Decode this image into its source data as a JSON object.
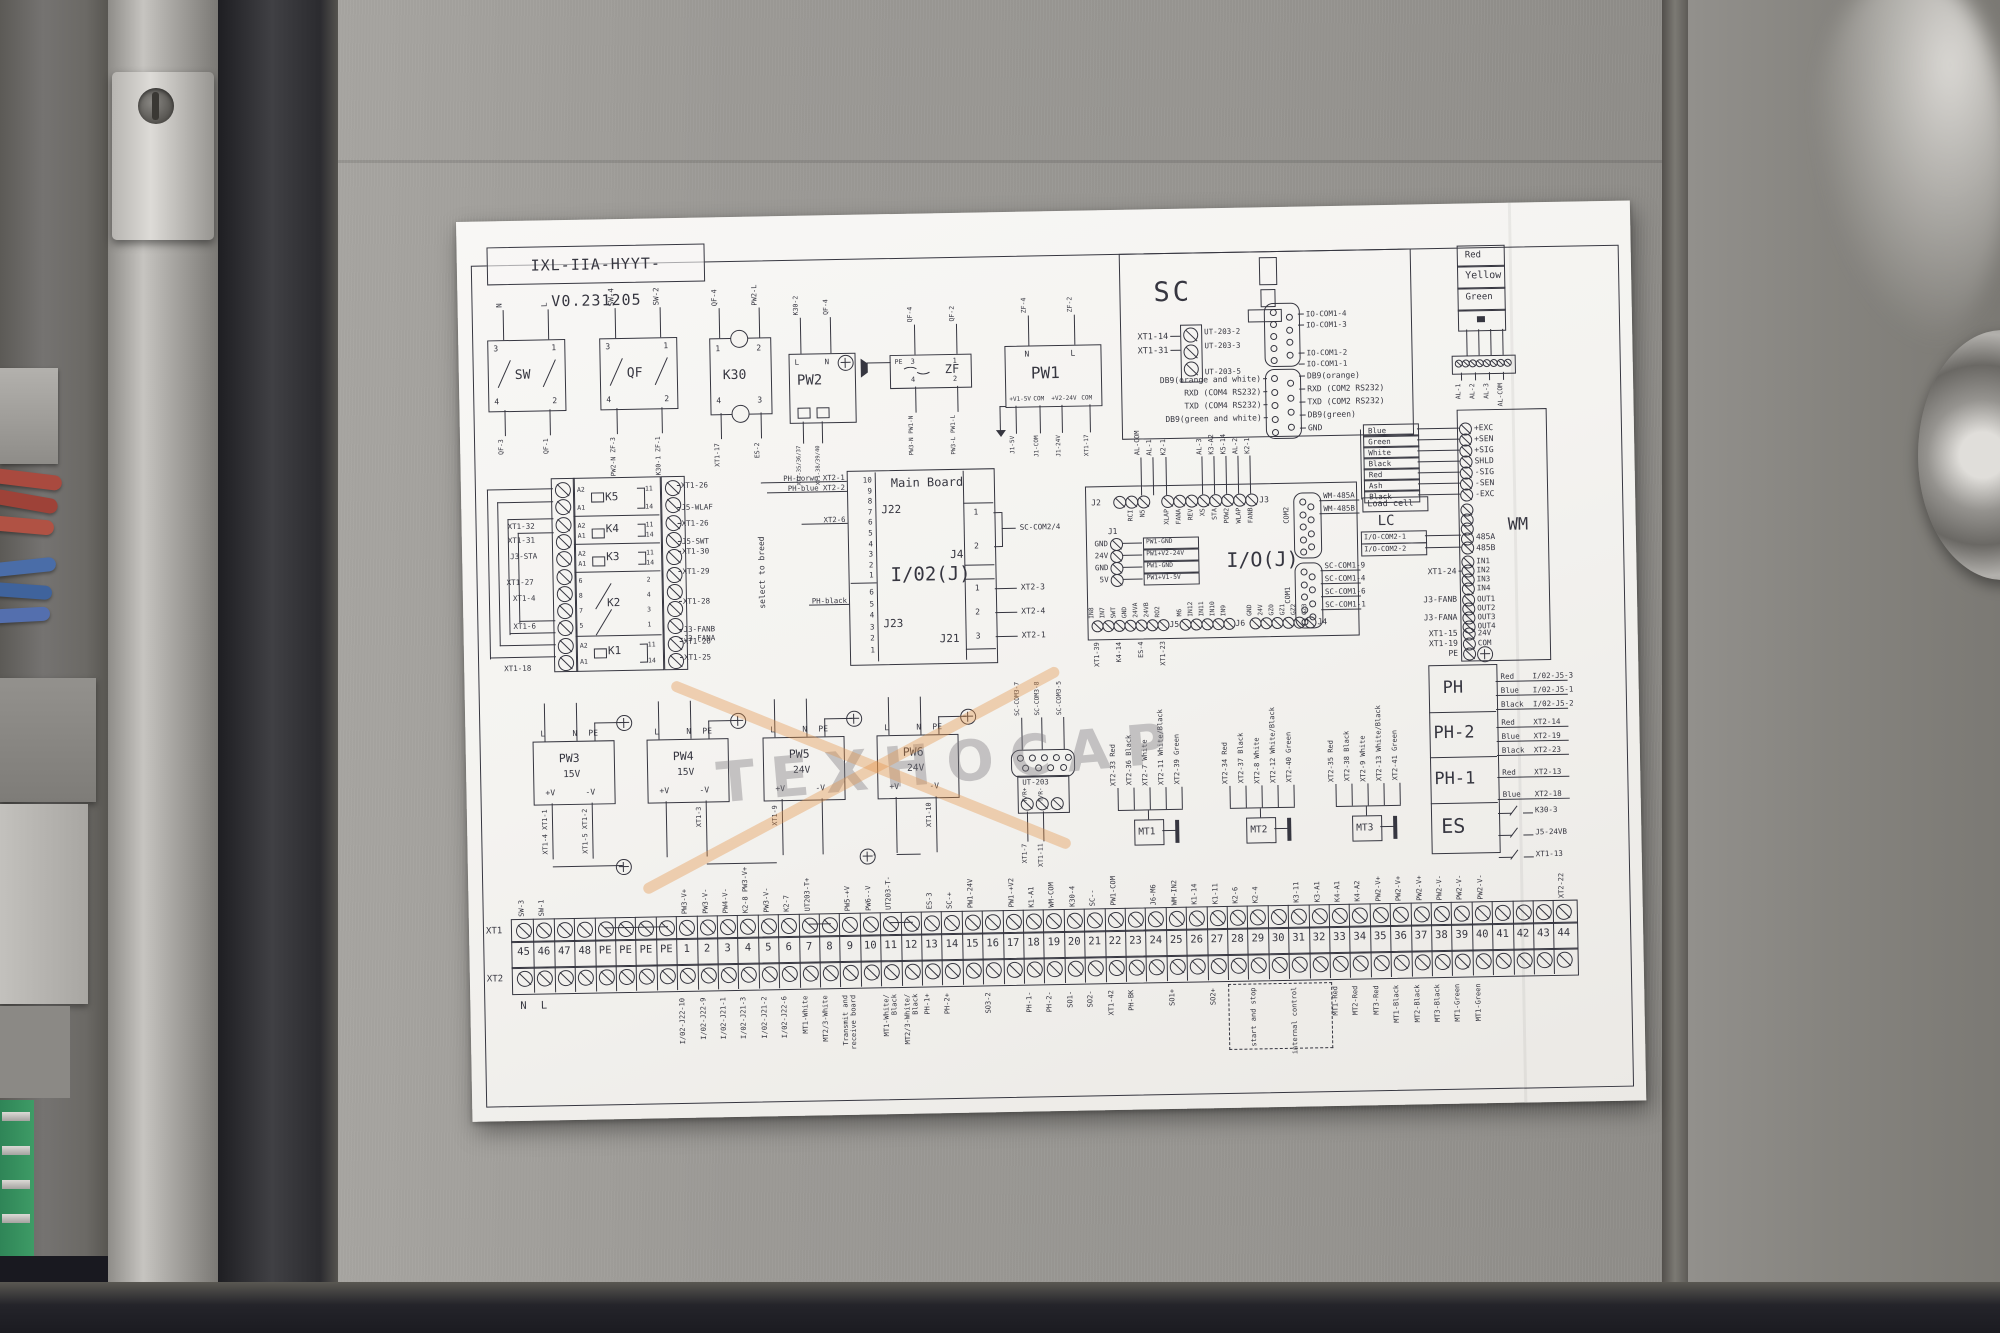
{
  "sheet": {
    "title": "IXL-IIA-HYYT-V0.231205",
    "watermark": "TEXHOCAP"
  },
  "colors": {
    "ink": "#363640",
    "paper": "#f4f3f0",
    "steel": "#9a9894",
    "steel_dark": "#2b2b2f",
    "watermark_gray": "#7c7a80",
    "watermark_orange": "#e49448",
    "pcb_green": "#3e9b66",
    "cable_red": "#a94a3f",
    "cable_blue": "#4a6da8"
  },
  "top_row": {
    "sw": {
      "name": "SW",
      "top_pins": [
        "3",
        "1"
      ],
      "bot_pins": [
        "4",
        "2"
      ],
      "top_wires": [
        "N",
        "L"
      ],
      "bot_wires": [
        "QF-3",
        "QF-1"
      ]
    },
    "qf": {
      "name": "QF",
      "top_pins": [
        "3",
        "1"
      ],
      "bot_pins": [
        "4",
        "2"
      ],
      "top_wires": [
        "SW-4",
        "SW-2"
      ],
      "bot_wires": [
        "PW2-N ZF-3",
        "K30-1 ZF-1"
      ]
    },
    "k30": {
      "name": "K30",
      "top_pins": [
        "1",
        "2"
      ],
      "bot_pins": [
        "4",
        "3"
      ],
      "top_wires": [
        "QF-4",
        "PW2-L"
      ],
      "bot_wires": [
        "XT1-17",
        "ES-2"
      ]
    },
    "pw2": {
      "name": "PW2",
      "top_pins": [
        "L",
        "N"
      ],
      "top_wires": [
        "K30-2",
        "QF-4"
      ],
      "bot_wires": [
        "XT1-35/36/37",
        "XT1-38/39/40"
      ]
    },
    "zf": {
      "name": "ZF",
      "top_pins": [
        "PE",
        "3",
        "1"
      ],
      "top_wires": [
        "QF-4",
        "QF-2"
      ],
      "bot_pins": [
        "4",
        "2"
      ],
      "bot_wires": [
        "PW3-N PW1-N",
        "PW3-L PW1-L"
      ]
    },
    "pw1": {
      "name": "PW1",
      "top_pins": [
        "N",
        "L"
      ],
      "top_wires": [
        "ZF-4",
        "ZF-2"
      ],
      "bot_terms": [
        "+V1-5V",
        "COM",
        "+V2-24V",
        "COM"
      ],
      "bot_wires": [
        "J1-5V",
        "J1-COM",
        "J1-24V",
        "XT1-17"
      ]
    }
  },
  "sc": {
    "name": "SC",
    "left_terms": [
      "XT1-14",
      "XT1-31"
    ],
    "ut_wires": [
      "UT-203-2",
      "UT-203-3",
      "UT-203-5"
    ],
    "io_com": [
      "IO-COM1-4",
      "IO-COM1-3",
      "IO-COM1-2",
      "IO-COM1-1"
    ],
    "db9_left": [
      "DB9(orange and white)",
      "RXD (COM4 RS232)",
      "TXD (COM4 RS232)",
      "DB9(green and white)"
    ],
    "db9_right": [
      "DB9(orange)",
      "RXD (COM2 RS232)",
      "TXD (COM2 RS232)",
      "DB9(green)",
      "GND"
    ]
  },
  "tower": {
    "lamps": [
      "Red",
      "Yellow",
      "Green"
    ],
    "wires": [
      "AL-1",
      "AL-2",
      "AL-3",
      "AL-COM"
    ]
  },
  "wm": {
    "name": "WM",
    "lc_box": "Load cell",
    "lc": "LC",
    "loadcell": [
      [
        "Blue",
        "+EXC"
      ],
      [
        "Green",
        "+SEN"
      ],
      [
        "White",
        "+SIG"
      ],
      [
        "Black",
        "SHLD"
      ],
      [
        "Red",
        "-SIG"
      ],
      [
        "Ash",
        "-SEN"
      ],
      [
        "Black",
        "-EXC"
      ]
    ],
    "rs485": [
      [
        "I/O-COM2-1",
        "485A"
      ],
      [
        "I/O-COM2-2",
        "485B"
      ]
    ],
    "in_label": "XT1-24",
    "ins": [
      "IN1",
      "IN2",
      "IN3",
      "IN4"
    ],
    "out_labels": [
      "J3-FANB",
      "J3-FANA"
    ],
    "outs": [
      "OUT1",
      "OUT2",
      "OUT3",
      "OUT4"
    ],
    "pwr": [
      [
        "XT1-15",
        "24V"
      ],
      [
        "XT1-19",
        "COM"
      ],
      [
        "PE",
        ""
      ]
    ]
  },
  "relays": {
    "note": "select to breed",
    "rows": [
      {
        "name": "K5",
        "lp": [
          "A2",
          "A1"
        ],
        "rp": [
          "11",
          "14"
        ],
        "ll": [],
        "rl": [
          "XT1-26",
          "J5-WLAF"
        ]
      },
      {
        "name": "K4",
        "lp": [
          "A2",
          "A1"
        ],
        "rp": [
          "11",
          "14"
        ],
        "ll": [
          "XT1-32",
          "XT1-31"
        ],
        "rl": [
          "XT1-26",
          "J5-SWT"
        ]
      },
      {
        "name": "K3",
        "lp": [
          "A2",
          "A1"
        ],
        "rp": [
          "11",
          "14"
        ],
        "ll": [
          "J3-STA"
        ],
        "rl": [
          "XT1-30",
          "XT1-29"
        ]
      },
      {
        "name": "K2",
        "lp": [
          "6",
          "8",
          "7",
          "5"
        ],
        "rp": [
          "2",
          "4",
          "3",
          "1"
        ],
        "ll": [
          "XT1-27",
          "XT1-4",
          "XT1-6"
        ],
        "rl": [
          "XT1-28",
          "J3-FANB",
          "J3-FANA"
        ]
      },
      {
        "name": "K1",
        "lp": [
          "A2",
          "A1"
        ],
        "rp": [
          "11",
          "14"
        ],
        "ll": [
          "XT1-18"
        ],
        "rl": [
          "XT1-26",
          "XT1-25"
        ]
      }
    ]
  },
  "main_board": {
    "title": "Main Board",
    "chip": "I/02(J)",
    "j22": {
      "name": "J22",
      "pins": [
        "10",
        "9",
        "8",
        "7",
        "6",
        "5",
        "4",
        "3",
        "2",
        "1"
      ],
      "w10": "PH-borwn XT2-1",
      "w9": "PH-blue XT2-2",
      "w6": "XT2-6"
    },
    "j23": {
      "name": "J23",
      "pins": [
        "6",
        "5",
        "4",
        "3",
        "2",
        "1"
      ],
      "w5": "PH-black"
    },
    "j4": {
      "name": "J4",
      "pins": [
        "1",
        "2"
      ],
      "wire": "SC-COM2/4"
    },
    "j21": {
      "name": "J21",
      "pins": [
        "1",
        "2",
        "3"
      ],
      "wires": [
        "XT2-3",
        "XT2-4",
        "XT2-1"
      ]
    }
  },
  "io": {
    "name": "I/O(J)",
    "j2": {
      "name": "J2",
      "pins": [
        "RCI",
        "N5"
      ],
      "top": [
        "AL-COM",
        "AL-1"
      ]
    },
    "j3": {
      "name": "J3",
      "pins": [
        "XLAP",
        "FANA",
        "REV",
        "XS",
        "STA",
        "POW2",
        "WLAP",
        "FANB"
      ],
      "top": [
        "K2-1",
        "AL-3",
        "K3-A2",
        "K5-14",
        "AL-2",
        "K2-1"
      ]
    },
    "j1": {
      "name": "J1",
      "rows": [
        [
          "GND",
          "PW1-GND"
        ],
        [
          "24V",
          "PW1+V2-24V"
        ],
        [
          "GND",
          "PW1-GND"
        ],
        [
          "5V",
          "PW1+V1-5V"
        ]
      ]
    },
    "com2": {
      "name": "COM2",
      "wires": [
        "WM-485A",
        "WM-485B"
      ]
    },
    "com1": {
      "name": "COM1",
      "wires": [
        "SC-COM1-9",
        "SC-COM1-4",
        "SC-COM1-6",
        "SC-COM1-1"
      ]
    },
    "j5": {
      "name": "J5",
      "pins": [
        "IN8",
        "IN7",
        "SWT",
        "GND",
        "24VA",
        "24VB",
        "RO2"
      ],
      "below": [
        "XT1-39",
        "K4-14",
        "ES-4",
        "XT1-23"
      ]
    },
    "j6": {
      "name": "J6",
      "pins": [
        "M6",
        "IN12",
        "IN11",
        "IN10",
        "IN9"
      ]
    },
    "j4b": {
      "name": "J4",
      "pins": [
        "GND",
        "24V",
        "GZ0",
        "GZ1",
        "GZ2",
        "GZ3"
      ]
    }
  },
  "pw": [
    {
      "name": "PW3",
      "volt": "15V",
      "tp": [
        "L",
        "N",
        "PE"
      ],
      "bp": [
        "+V",
        "-V"
      ],
      "bw": [
        "XT1-4 XT1-1",
        "XT1-5 XT1-2"
      ]
    },
    {
      "name": "PW4",
      "volt": "15V",
      "tp": [
        "L",
        "N",
        "PE"
      ],
      "bp": [
        "+V",
        "-V"
      ],
      "bw": [
        "",
        "XT1-3"
      ]
    },
    {
      "name": "PW5",
      "volt": "24V",
      "tp": [
        "L",
        "N",
        "PE"
      ],
      "bp": [
        "+V",
        "-V"
      ],
      "bw": [
        "XT1-9",
        ""
      ]
    },
    {
      "name": "PW6",
      "volt": "24V",
      "tp": [
        "L",
        "N",
        "PE"
      ],
      "bp": [
        "+V",
        "-V"
      ],
      "bw": [
        "",
        "XT1-10"
      ]
    }
  ],
  "ut203": {
    "name": "UT-203",
    "top": [
      "SC-COM3-7",
      "SC-COM3-8",
      "SC-COM3-5"
    ],
    "mid": [
      "T/R+",
      "T/R-"
    ],
    "bot": [
      "XT1-7",
      "XT1-11"
    ]
  },
  "mt": [
    {
      "name": "MT1",
      "wires": [
        "XT2-33 Red",
        "XT2-36 Black",
        "XT2-7 White",
        "XT2-11 White/Black",
        "XT2-39 Green"
      ]
    },
    {
      "name": "MT2",
      "wires": [
        "XT2-34 Red",
        "XT2-37 Black",
        "XT2-8 White",
        "XT2-12 White/Black",
        "XT2-40 Green"
      ]
    },
    {
      "name": "MT3",
      "wires": [
        "XT2-35 Red",
        "XT2-38 Black",
        "XT2-9 White",
        "XT2-13 White/Black",
        "XT2-41 Green"
      ]
    }
  ],
  "ph": [
    {
      "name": "PH",
      "wires": [
        [
          "Red",
          "I/02-J5-3"
        ],
        [
          "Blue",
          "I/02-J5-1"
        ],
        [
          "Black",
          "I/02-J5-2"
        ]
      ]
    },
    {
      "name": "PH-2",
      "wires": [
        [
          "Red",
          "XT2-14"
        ],
        [
          "Blue",
          "XT2-19"
        ],
        [
          "Black",
          "XT2-23"
        ]
      ]
    },
    {
      "name": "PH-1",
      "wires": [
        [
          "Red",
          "XT2-13"
        ],
        [
          "Blue",
          "XT2-18"
        ]
      ]
    },
    {
      "name": "ES",
      "wires": [
        [
          "",
          "K30-3"
        ],
        [
          "",
          "J5-24VB"
        ],
        [
          "",
          "XT1-13"
        ]
      ]
    }
  ],
  "strip": {
    "row1": "XT1",
    "row2": "XT2",
    "numbers": [
      "45",
      "46",
      "47",
      "48",
      "PE",
      "PE",
      "PE",
      "PE",
      "1",
      "2",
      "3",
      "4",
      "5",
      "6",
      "7",
      "8",
      "9",
      "10",
      "11",
      "12",
      "13",
      "14",
      "15",
      "16",
      "17",
      "18",
      "19",
      "20",
      "21",
      "22",
      "23",
      "24",
      "25",
      "26",
      "27",
      "28",
      "29",
      "30",
      "31",
      "32",
      "33",
      "34",
      "35",
      "36",
      "37",
      "38",
      "39",
      "40",
      "41",
      "42",
      "43",
      "44"
    ],
    "top_labels": [
      "SW-3",
      "SW-1",
      "",
      "",
      "",
      "",
      "",
      "",
      "PW3-V+",
      "PW3-V-",
      "PW4-V-",
      "K2-8 PW3-V+",
      "PW3-V-",
      "K2-7",
      "UT203-T+",
      "",
      "PW5-+V",
      "PW6--V",
      "UT203-T-",
      "",
      "ES-3",
      "SC-+",
      "PW1-24V",
      "",
      "PW1-+V2",
      "K1-A1",
      "WM-COM",
      "K30-4",
      "SC--",
      "PW1-COM",
      "",
      "J6-M6",
      "WM-IN2",
      "K1-14",
      "K1-11",
      "K2-6",
      "K2-4",
      "",
      "K3-11",
      "K3-A1",
      "K4-A1",
      "K4-A2",
      "PW2-V+",
      "PW2-V+",
      "PW2-V+",
      "PW2-V-",
      "PW2-V-",
      "PW2-V-",
      "",
      "",
      "",
      "XT2-22"
    ],
    "bottom_labels": [
      "N",
      "L",
      "",
      "",
      "",
      "",
      "",
      "",
      "I/02-J22-10",
      "I/02-J22-9",
      "I/02-J21-1",
      "I/02-J21-3",
      "I/02-J21-2",
      "I/02-J22-6",
      "MT1-White",
      "MT2/3-White",
      "Transmit and|receive board",
      "",
      "MT1-White/|Black",
      "MT2/3-White/|Black",
      "PH-1+",
      "PH-2+",
      "",
      "SO3-2",
      "",
      "PH-1-",
      "PH-2-",
      "SO1-",
      "SO2-",
      "XT1-42",
      "PH-BK",
      "",
      "SO1+",
      "",
      "SO2+",
      "",
      "start and stop",
      "",
      "internal control",
      "",
      "MT1-Red",
      "MT2-Red",
      "MT3-Red",
      "MT1-Black",
      "MT2-Black",
      "MT3-Black",
      "MT1-Green",
      "MT1-Green",
      "",
      "",
      "",
      ""
    ]
  }
}
